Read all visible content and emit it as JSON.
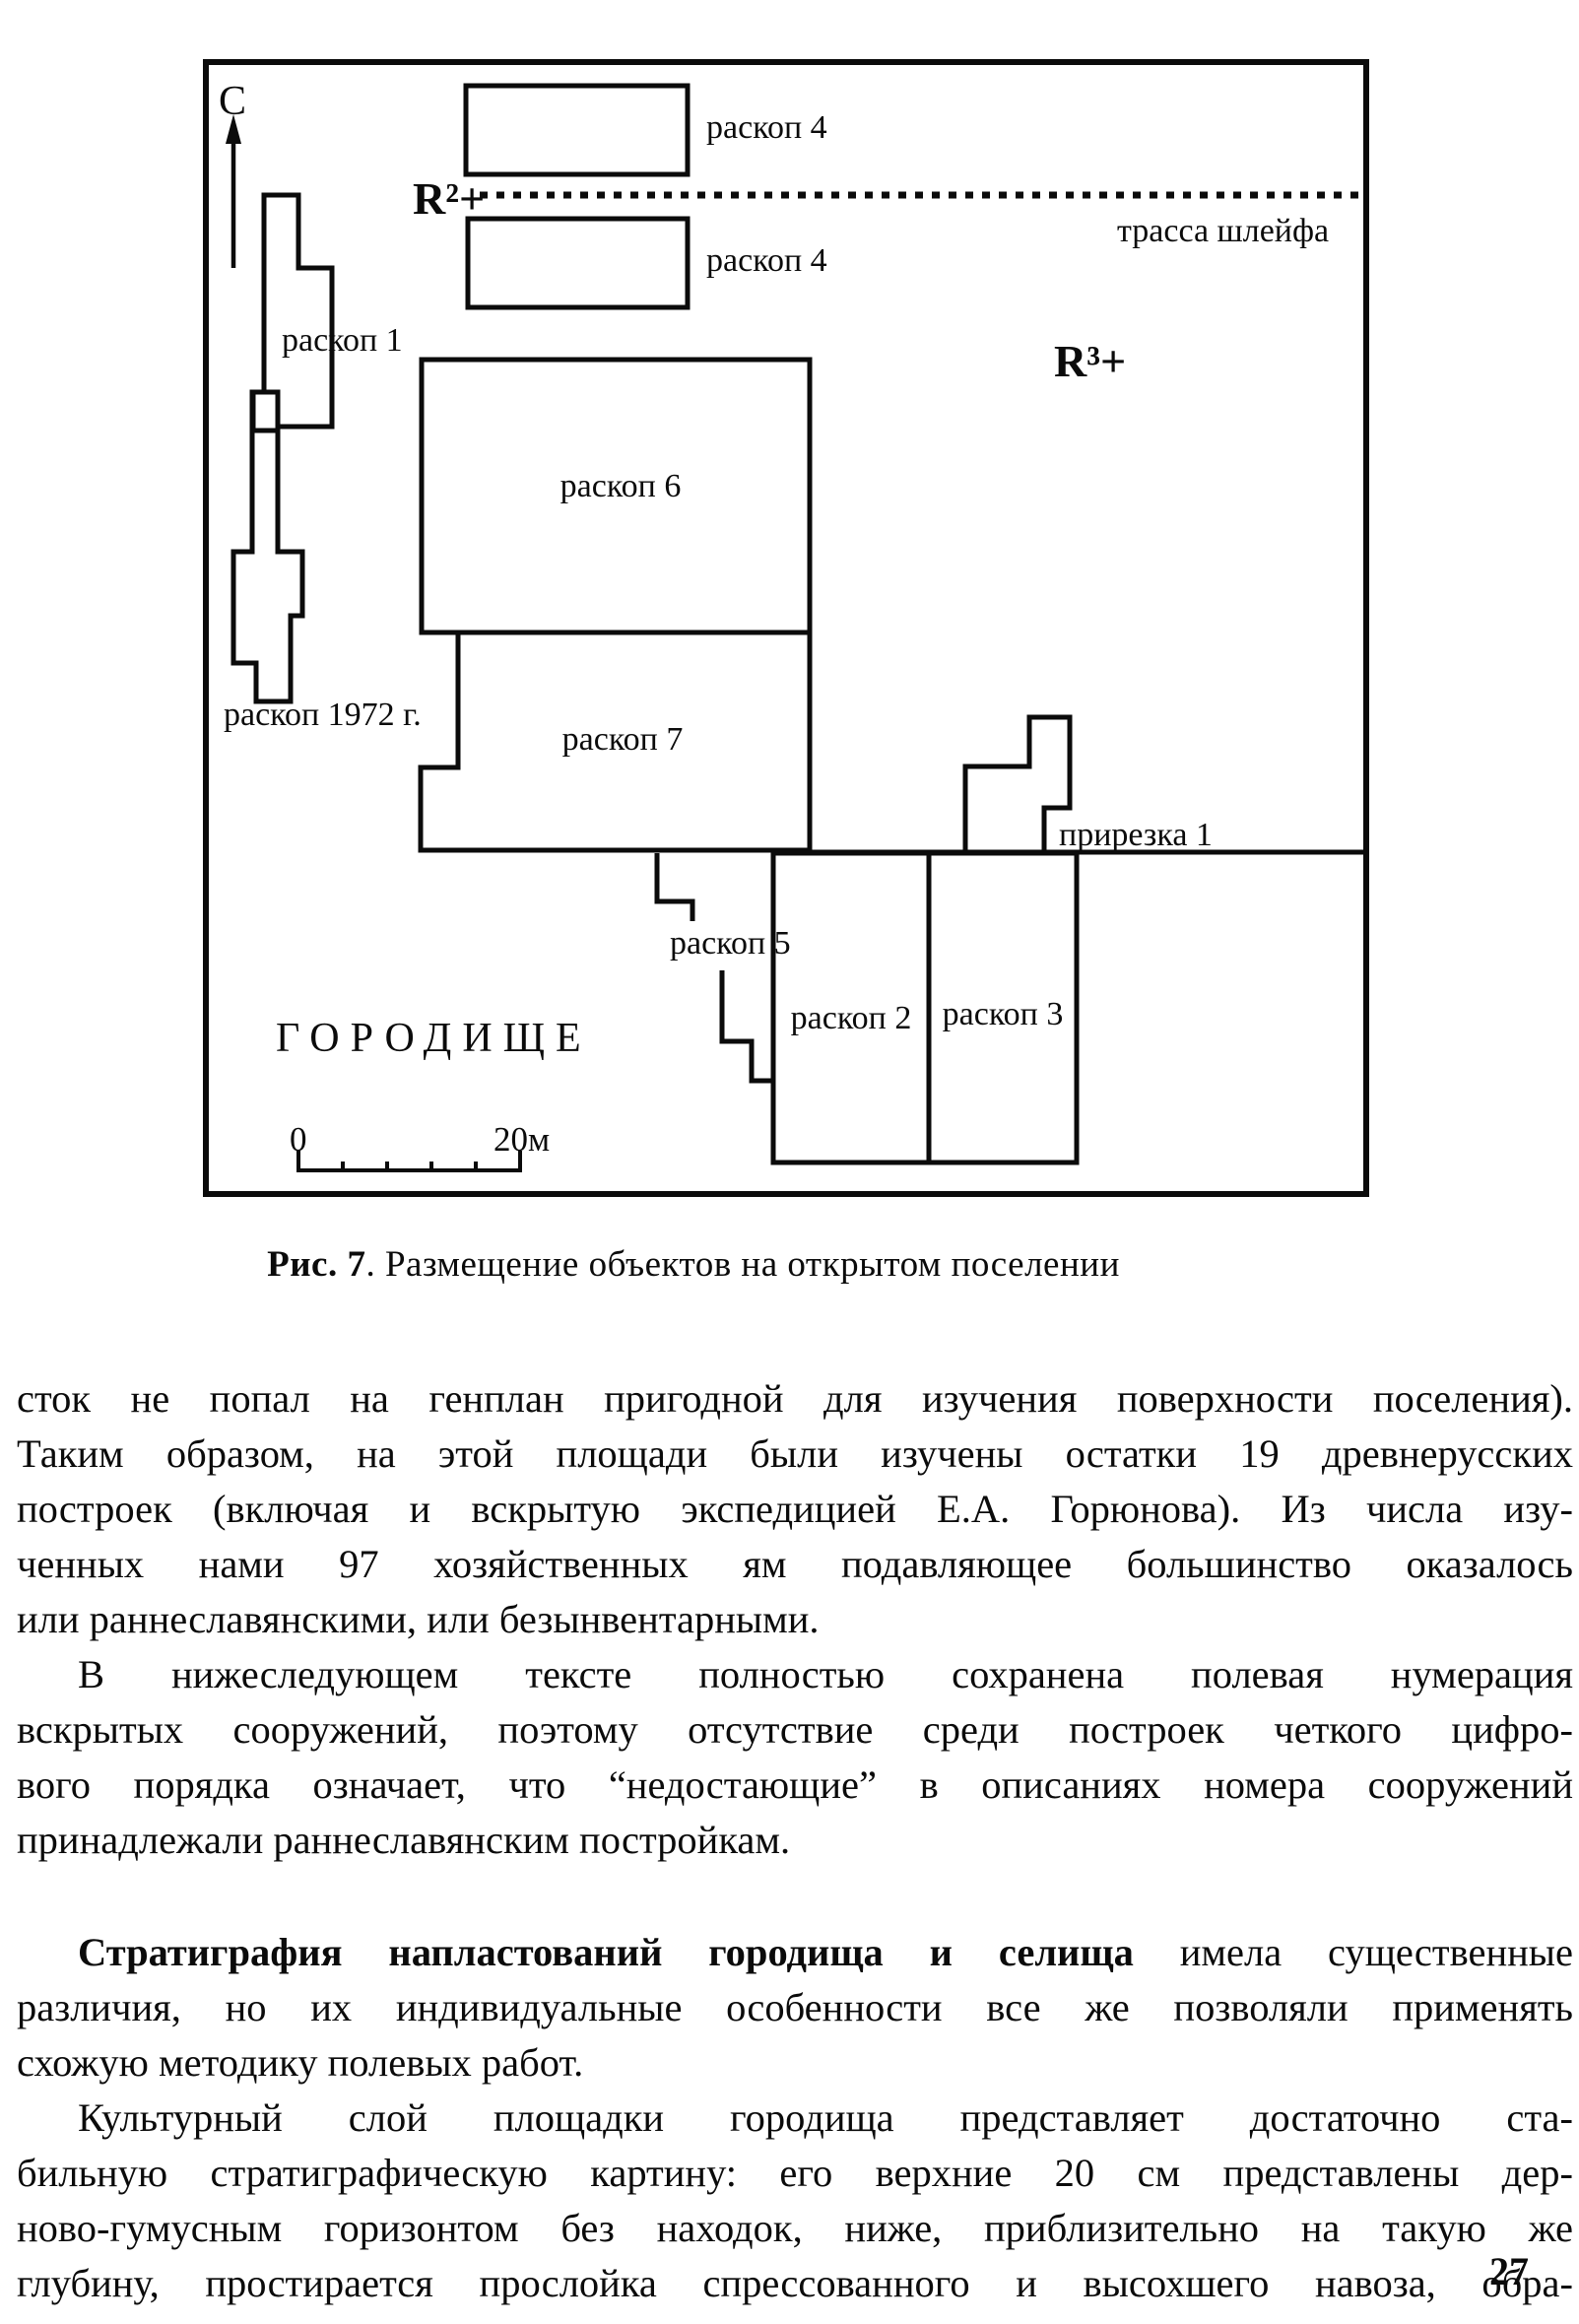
{
  "figure": {
    "north": "С",
    "labels": {
      "raskop1": "раскоп 1",
      "raskop4_top": "раскоп 4",
      "raskop4_bottom": "раскоп 4",
      "raskop6": "раскоп 6",
      "raskop7": "раскоп 7",
      "raskop5": "раскоп 5",
      "raskop2": "раскоп 2",
      "raskop3": "раскоп 3",
      "raskop1972": "раскоп 1972 г.",
      "prirezka1": "прирезка 1",
      "trassa_shleyfa": "трасса шлейфа",
      "r2": "R²+",
      "r3": "R³+",
      "gorodishche": "ГОРОДИЩЕ",
      "scale_start": "0",
      "scale_end": "20м"
    },
    "caption": {
      "bold": "Рис. 7",
      "rest": ". Размещение объектов на открытом поселении"
    }
  },
  "body": {
    "p1": {
      "lines": [
        "сток не попал на генплан пригодной для изучения поверхности поселения).",
        "Таким образом, на этой площади были изучены остатки 19 древнерусских",
        "построек (включая и вскрытую экспедицией Е.А. Горюнова). Из числа изу-",
        "ченных нами 97 хозяйственных ям подавляющее большинство оказалось",
        "или раннеславянскими, или безынвентарными."
      ]
    },
    "p2": {
      "lines": [
        "В нижеследующем тексте полностью сохранена полевая нумерация",
        "вскрытых сооружений, поэтому отсутствие среди построек четкого цифро-",
        "вого порядка означает, что “недостающие” в описаниях номера сооружений",
        "принадлежали раннеславянским постройкам."
      ]
    },
    "p3": {
      "line0_bold": "Стратиграфия напластований городища и селища",
      "line0_rest": " имела существенные",
      "lines": [
        "различия, но их индивидуальные особенности все же позволяли применять",
        "схожую методику полевых работ."
      ]
    },
    "p4": {
      "lines": [
        "Культурный слой площадки городища представляет достаточно ста-",
        "бильную стратиграфическую картину: его верхние 20 см представлены дер-",
        "ново-гумусным горизонтом без находок, ниже, приблизительно на такую же",
        "глубину, простирается прослойка спрессованного и высохшего навоза, обра-"
      ]
    }
  },
  "page_number": "27"
}
